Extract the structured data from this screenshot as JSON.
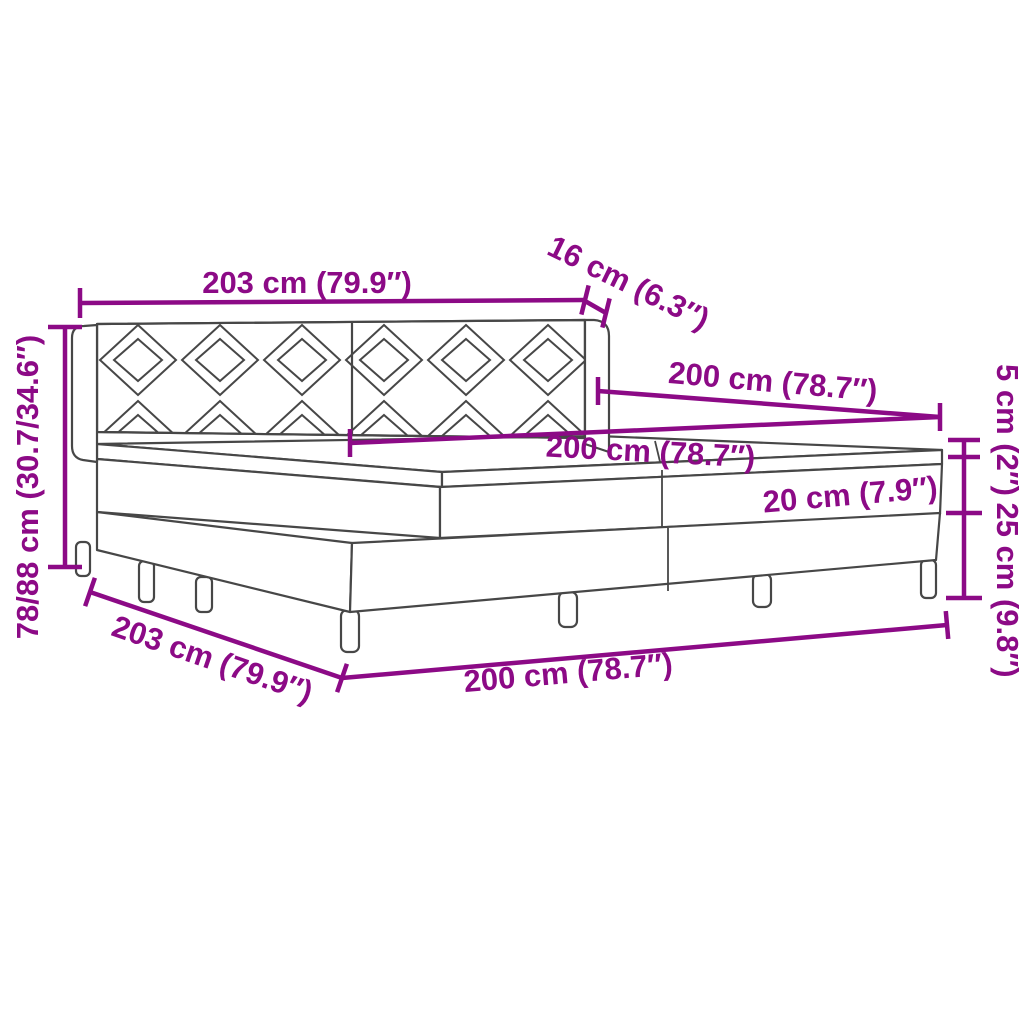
{
  "diagram": {
    "title": "Box spring bed with mattress — dimension diagram",
    "colors": {
      "dimension_accent": "#8c0a86",
      "drawing_line": "#474747",
      "background": "#ffffff"
    },
    "labels": {
      "headboard_width": "203 cm (79.9″)",
      "headboard_depth": "16 cm (6.3″)",
      "bed_length_top": "200 cm (78.7″)",
      "mattress_length": "200 cm (78.7″)",
      "topper_height": "5 cm (2″)",
      "mattress_height": "20 cm (7.9″)",
      "base_height": "25 cm (9.8″)",
      "total_height": "78/88 cm (30.7/34.6″)",
      "base_width_bottom": "203 cm (79.9″)",
      "base_length_bottom": "200 cm (78.7″)"
    }
  }
}
